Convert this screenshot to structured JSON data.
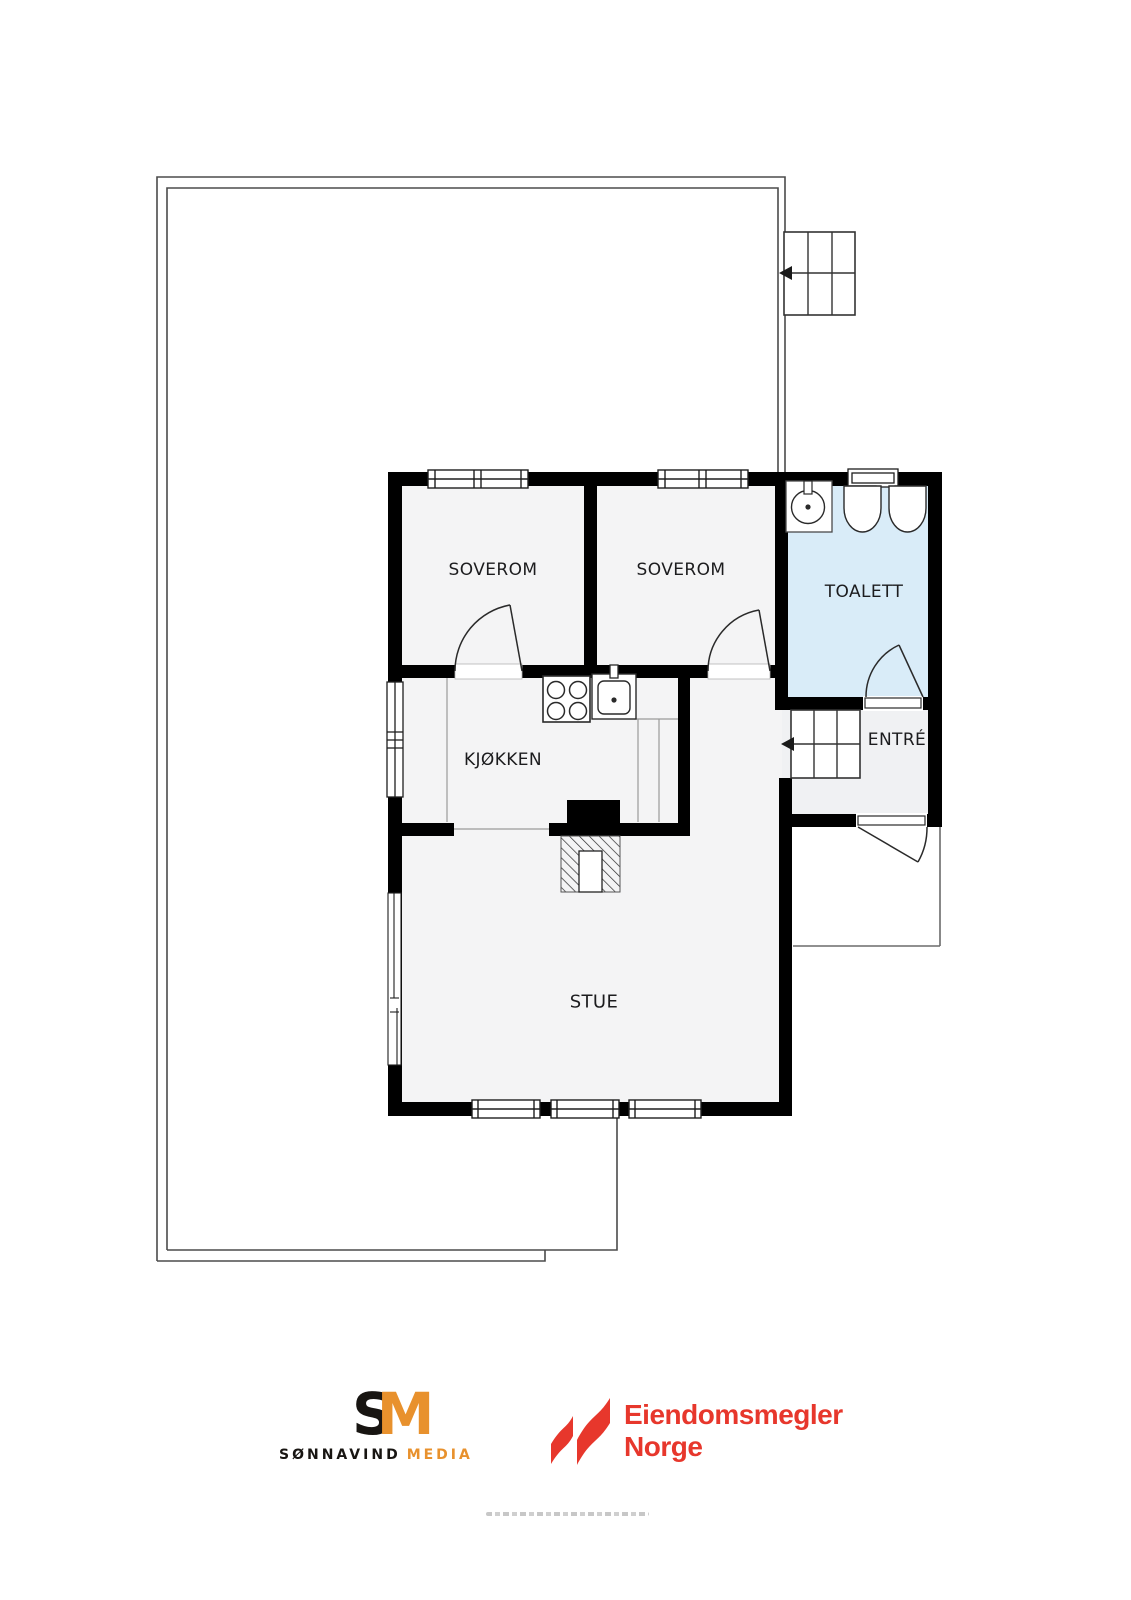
{
  "plan": {
    "rooms": [
      {
        "id": "bedroom-1",
        "label": "SOVEROM"
      },
      {
        "id": "bedroom-2",
        "label": "SOVEROM"
      },
      {
        "id": "toilet",
        "label": "TOALETT"
      },
      {
        "id": "kitchen",
        "label": "KJØKKEN"
      },
      {
        "id": "entry",
        "label": "ENTRÉ"
      },
      {
        "id": "living-room",
        "label": "STUE"
      }
    ],
    "fixtures": [
      "exterior-stairs-icon",
      "entry-stairs-icon",
      "stair-direction-arrow-icon",
      "toilet-sink-icon",
      "toilet-bowl-icon",
      "stove-icon",
      "kitchen-sink-icon",
      "fireplace-icon",
      "chimney-block",
      "window-icon",
      "door-swing-icon",
      "terrace-outline",
      "porch-outline"
    ],
    "colors": {
      "wall": "#000000",
      "room_fill": "#f4f4f5",
      "toilet_fill": "#d9ecf8",
      "terrace_line": "#4b4b4b",
      "counter_line": "#9a9a9a"
    }
  },
  "footer": {
    "sonnavind": {
      "monogram_s": "S",
      "monogram_m": "M",
      "name": "SØNNAVIND",
      "suffix": "MEDIA",
      "orange": "#e8912d",
      "dark": "#181512"
    },
    "agency": {
      "line1": "Eiendomsmegler",
      "line2": "Norge",
      "red": "#e7372c"
    }
  }
}
